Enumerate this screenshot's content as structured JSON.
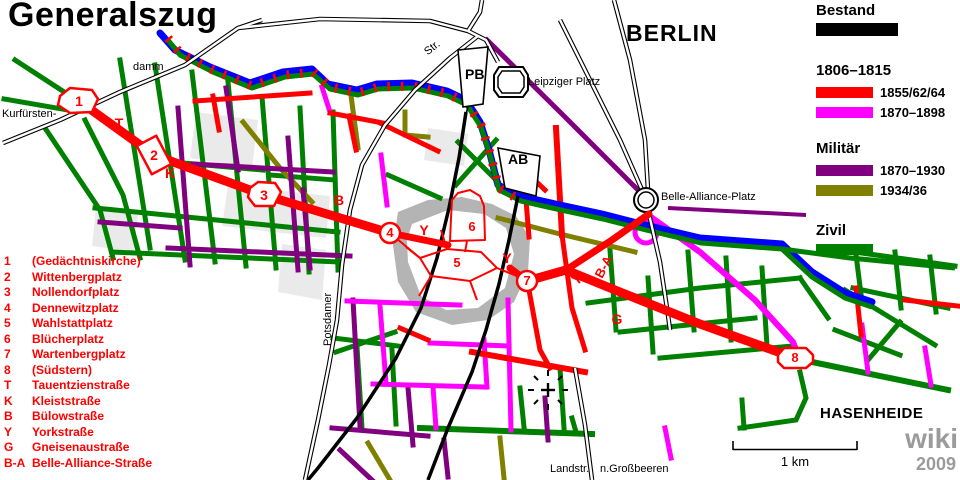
{
  "title": "Generalszug",
  "city_label": "BERLIN",
  "watermark": {
    "line1": "wiki",
    "line2": "2009"
  },
  "scale": {
    "label": "1 km"
  },
  "places": {
    "leipziger_platz": "Leipziger Platz",
    "belle_alliance_platz": "Belle-Alliance-Platz",
    "potsdamer_bahnhof_abbrev": "PB",
    "anhalter_bahnhof_abbrev": "AB",
    "kurfuersten": "Kurfürsten-",
    "damm": "damm",
    "str_abbrev": "Str.",
    "potsdamer": "Potsdamer",
    "landstr": "Landstr.",
    "grossbeeren": "n.Großbeeren",
    "hasenheide": "HASENHEIDE"
  },
  "legend": {
    "bestand_label": "Bestand",
    "bestand_color": "#000000",
    "period_label": "1806–1815",
    "built_rows": [
      {
        "label": "1855/62/64",
        "color": "#ff0000"
      },
      {
        "label": "1870–1898",
        "color": "#ff00ff"
      }
    ],
    "militaer_label": "Militär",
    "militaer_rows": [
      {
        "label": "1870–1930",
        "color": "#800080"
      },
      {
        "label": "1934/36",
        "color": "#808000"
      }
    ],
    "zivil_label": "Zivil",
    "zivil_color": "#008000"
  },
  "key": {
    "items": [
      {
        "marker": "1",
        "name": "(Gedächtniskirche)"
      },
      {
        "marker": "2",
        "name": "Wittenbergplatz"
      },
      {
        "marker": "3",
        "name": "Nollendorfplatz"
      },
      {
        "marker": "4",
        "name": "Dennewitzplatz"
      },
      {
        "marker": "5",
        "name": "Wahlstattplatz"
      },
      {
        "marker": "6",
        "name": "Blücherplatz"
      },
      {
        "marker": "7",
        "name": "Wartenbergplatz"
      },
      {
        "marker": "8",
        "name": "(Südstern)"
      },
      {
        "marker": "T",
        "name": "Tauentzienstraße"
      },
      {
        "marker": "K",
        "name": "Kleiststraße"
      },
      {
        "marker": "B",
        "name": "Bülowstraße"
      },
      {
        "marker": "Y",
        "name": "Yorkstraße"
      },
      {
        "marker": "G",
        "name": "Gneisenaustraße"
      },
      {
        "marker": "B-A",
        "name": "Belle-Alliance-Straße"
      }
    ]
  },
  "route_markers": {
    "m1": "1",
    "m2": "2",
    "m3": "3",
    "m4": "4",
    "m5": "5",
    "m6": "6",
    "m7": "7",
    "m8": "8",
    "t": "T",
    "k": "K",
    "b": "B",
    "y": "Y",
    "g": "G",
    "ba": "B-A"
  },
  "colors": {
    "bestand": "#000000",
    "built_1855": "#ff0000",
    "built_1870_1898": "#ff00ff",
    "militaer_1870_1930": "#800080",
    "militaer_1934_36": "#808000",
    "zivil": "#008000",
    "water": "#0000ff",
    "railway": "#000000",
    "watermark_gray": "#9b9b9b"
  }
}
